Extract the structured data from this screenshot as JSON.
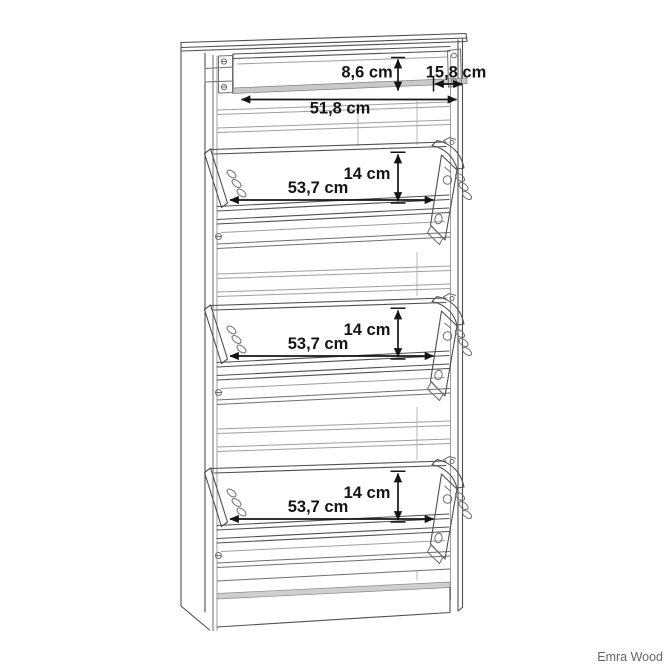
{
  "page": {
    "background": "#ffffff"
  },
  "watermark": {
    "text": "Emra Wood",
    "color": "#63666e"
  },
  "drawing": {
    "colors": {
      "outline": "#4f4f4f",
      "outline_light": "#9e9e9e",
      "dimension_text": "#151515",
      "panel_band": "#c9c9c9"
    },
    "top_section": {
      "inner_height_label": "8,6 cm",
      "depth_label": "15,8 cm",
      "inner_width_label": "51,8 cm"
    },
    "compartments": [
      {
        "width_label": "53,7 cm",
        "height_label": "14 cm"
      },
      {
        "width_label": "53,7 cm",
        "height_label": "14 cm"
      },
      {
        "width_label": "53,7 cm",
        "height_label": "14 cm"
      }
    ]
  }
}
